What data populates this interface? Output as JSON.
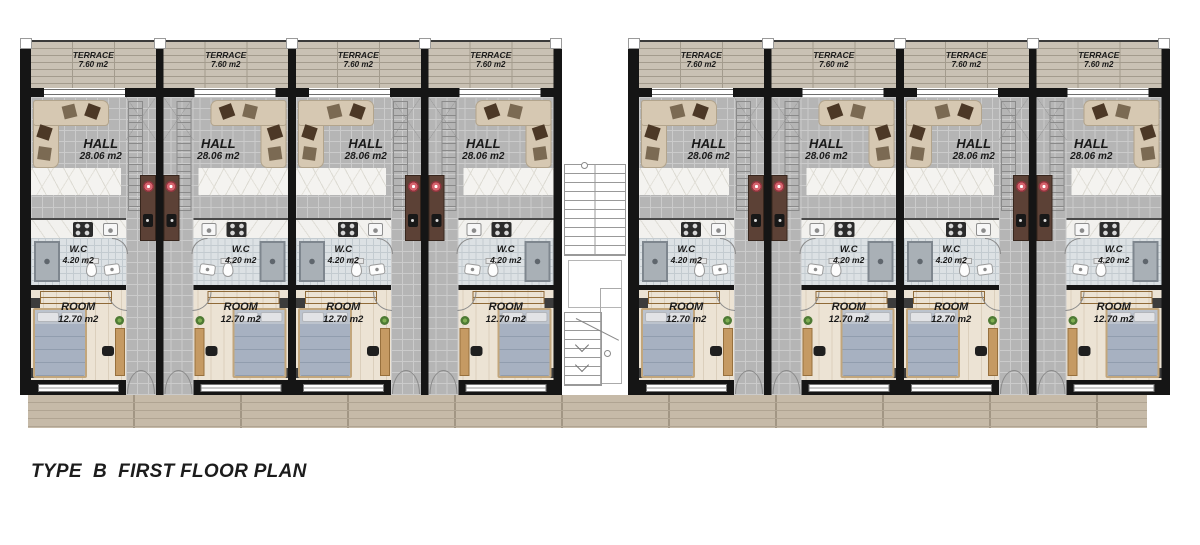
{
  "title": "TYPE  B  FIRST FLOOR PLAN",
  "units": [
    {
      "id": "unit-1",
      "block": "left",
      "mirrored": false,
      "terrace": {
        "name": "TERRACE",
        "area": "7.60 m2"
      },
      "hall": {
        "name": "HALL",
        "area": "28.06 m2"
      },
      "wc": {
        "name": "W.C",
        "area": "4.20 m2"
      },
      "room": {
        "name": "ROOM",
        "area": "12.70 m2"
      }
    },
    {
      "id": "unit-2",
      "block": "left",
      "mirrored": true,
      "terrace": {
        "name": "TERRACE",
        "area": "7.60 m2"
      },
      "hall": {
        "name": "HALL",
        "area": "28.06 m2"
      },
      "wc": {
        "name": "W.C",
        "area": "4.20 m2"
      },
      "room": {
        "name": "ROOM",
        "area": "12.70 m2"
      }
    },
    {
      "id": "unit-3",
      "block": "left",
      "mirrored": false,
      "terrace": {
        "name": "TERRACE",
        "area": "7.60 m2"
      },
      "hall": {
        "name": "HALL",
        "area": "28.06 m2"
      },
      "wc": {
        "name": "W.C",
        "area": "4.20 m2"
      },
      "room": {
        "name": "ROOM",
        "area": "12.70 m2"
      }
    },
    {
      "id": "unit-4",
      "block": "left",
      "mirrored": true,
      "terrace": {
        "name": "TERRACE",
        "area": "7.60 m2"
      },
      "hall": {
        "name": "HALL",
        "area": "28.06 m2"
      },
      "wc": {
        "name": "W.C",
        "area": "4.20 m2"
      },
      "room": {
        "name": "ROOM",
        "area": "12.70 m2"
      }
    },
    {
      "id": "unit-5",
      "block": "right",
      "mirrored": false,
      "terrace": {
        "name": "TERRACE",
        "area": "7.60 m2"
      },
      "hall": {
        "name": "HALL",
        "area": "28.06 m2"
      },
      "wc": {
        "name": "W.C",
        "area": "4.20 m2"
      },
      "room": {
        "name": "ROOM",
        "area": "12.70 m2"
      }
    },
    {
      "id": "unit-6",
      "block": "right",
      "mirrored": true,
      "terrace": {
        "name": "TERRACE",
        "area": "7.60 m2"
      },
      "hall": {
        "name": "HALL",
        "area": "28.06 m2"
      },
      "wc": {
        "name": "W.C",
        "area": "4.20 m2"
      },
      "room": {
        "name": "ROOM",
        "area": "12.70 m2"
      }
    },
    {
      "id": "unit-7",
      "block": "right",
      "mirrored": false,
      "terrace": {
        "name": "TERRACE",
        "area": "7.60 m2"
      },
      "hall": {
        "name": "HALL",
        "area": "28.06 m2"
      },
      "wc": {
        "name": "W.C",
        "area": "4.20 m2"
      },
      "room": {
        "name": "ROOM",
        "area": "12.70 m2"
      }
    },
    {
      "id": "unit-8",
      "block": "right",
      "mirrored": true,
      "terrace": {
        "name": "TERRACE",
        "area": "7.60 m2"
      },
      "hall": {
        "name": "HALL",
        "area": "28.06 m2"
      },
      "wc": {
        "name": "W.C",
        "area": "4.20 m2"
      },
      "room": {
        "name": "ROOM",
        "area": "12.70 m2"
      }
    }
  ],
  "colors": {
    "wall": "#151515",
    "hall_tile": "#b5b5b5",
    "tile_line": "#cbcbcb",
    "terrace_wood": "#c9c1b4",
    "terrace_line": "#a39b8d",
    "deck_wood": "#c6baa8",
    "deck_line": "#b0a492",
    "wc_tile": "#dce1e4",
    "wc_tile_line": "#c3cbd0",
    "room_floor": "#ece3d4",
    "room_floor_line": "#dbcfbc",
    "rug": "#f4f3f0",
    "sofa": "#d6c8b2",
    "sofa_edge": "#b2a48c",
    "cushion_dark": "#4c3826",
    "cushion_mid": "#7b6a53",
    "bar": "#5c4136",
    "stool": "#d6646e",
    "bed_mattress": "#bcc3cd",
    "bed_blanket": "#a7b1c1",
    "bed_frame": "#c2a67c",
    "pillow": "#e2e3e6",
    "wardrobe": "#c79a62",
    "wardrobe_edge": "#8f6a38",
    "desk": "#c59a63",
    "chair": "#1f1f1f",
    "plant": "#4e7a34",
    "text": "#191919"
  }
}
